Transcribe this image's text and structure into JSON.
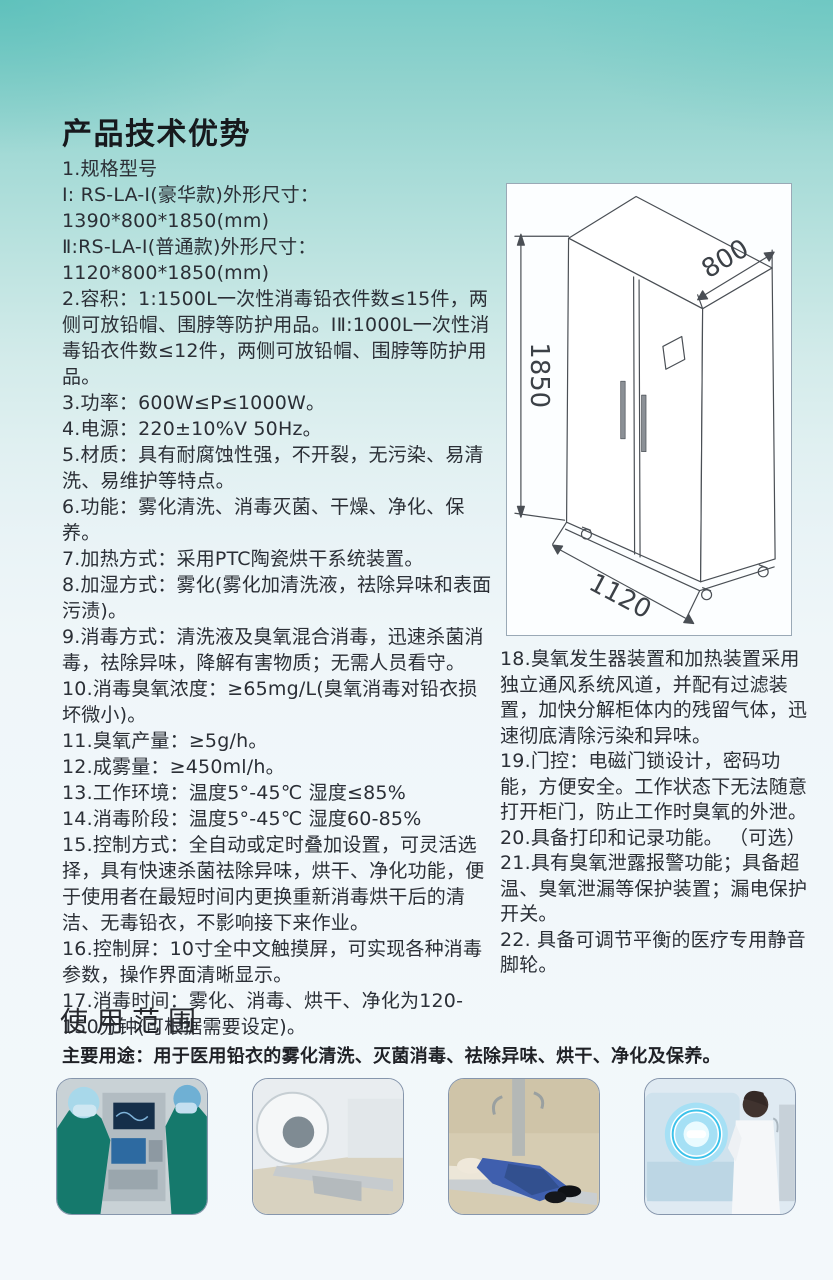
{
  "tech": {
    "heading": "产品技术优势",
    "left_items": [
      "1.规格型号",
      "I: RS-LA-I(豪华款)外形尺寸：1390*800*1850(mm)",
      "Ⅱ:RS-LA-I(普通款)外形尺寸：1120*800*1850(mm)",
      "2.容积：1:1500L一次性消毒铅衣件数≤15件，两侧可放铅帽、围脖等防护用品。IⅡ:1000L一次性消毒铅衣件数≤12件，两侧可放铅帽、围脖等防护用品。",
      "3.功率：600W≤P≤1000W。",
      "4.电源：220±10%V  50Hz。",
      "5.材质：具有耐腐蚀性强，不开裂，无污染、易清洗、易维护等特点。",
      "6.功能：雾化清洗、消毒灭菌、干燥、净化、保养。",
      "7.加热方式：采用PTC陶瓷烘干系统装置。",
      "8.加湿方式：雾化(雾化加清洗液，祛除异味和表面污渍)。",
      "9.消毒方式：清洗液及臭氧混合消毒，迅速杀菌消毒，祛除异味，降解有害物质；无需人员看守。",
      "10.消毒臭氧浓度：≥65mg/L(臭氧消毒对铅衣损坏微小)。",
      "11.臭氧产量：≥5g/h。",
      "12.成雾量：≥450ml/h。",
      "13.工作环境：温度5°-45℃ 湿度≤85%",
      "14.消毒阶段：温度5°-45℃ 湿度60-85%",
      "15.控制方式：全自动或定时叠加设置，可灵活选择，具有快速杀菌祛除异味，烘干、净化功能，便于使用者在最短时间内更换重新消毒烘干后的清洁、无毒铅衣，不影响接下来作业。",
      "16.控制屏：10寸全中文触摸屏，可实现各种消毒参数，操作界面清晰显示。",
      "17.消毒时间：雾化、消毒、烘干、净化为120-150分钟(可根据需要设定)。"
    ],
    "right_items": [
      "18.臭氧发生器装置和加热装置采用独立通风系统风道，并配有过滤装置，加快分解柜体内的残留气体，迅速彻底清除污染和异味。",
      "19.门控：电磁门锁设计，密码功能，方便安全。工作状态下无法随意打开柜门，防止工作时臭氧的外泄。",
      "20.具备打印和记录功能。 （可选）",
      "21.具有臭氧泄露报警功能；具备超温、臭氧泄漏等保护装置；漏电保护开关。",
      "22. 具备可调节平衡的医疗专用静音脚轮。"
    ]
  },
  "diagram": {
    "height_label": "1850",
    "depth_label": "800",
    "width_label": "1120"
  },
  "usage": {
    "heading": "使用范围",
    "main_use": "主要用途：用于医用铅衣的雾化清洗、灭菌消毒、祛除异味、烘干、净化及保养。",
    "photos": [
      "operating-room-surgeons-photo",
      "ct-scanner-room-photo",
      "xray-table-lead-apron-photo",
      "radiology-technician-photo"
    ]
  },
  "colors": {
    "accent_teal": "#79cbc7",
    "page_background": "#f3f8fb",
    "body_text": "#2b2f36"
  }
}
